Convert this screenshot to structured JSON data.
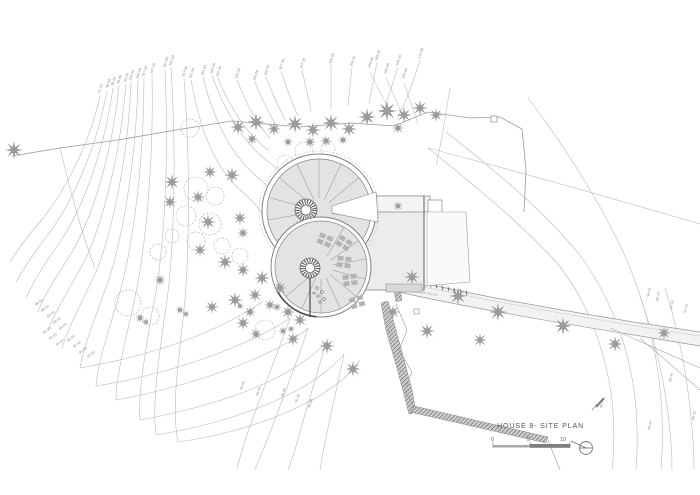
{
  "title_block": {
    "title": "HOUSE 8- SITE PLAN",
    "scale_marks": [
      "0",
      "5",
      "10"
    ]
  },
  "road_label": "ACCESS ROAD",
  "colors": {
    "paper": "#ffffff",
    "contour_line": "#b9b9b9",
    "building_fill": "#e3e3e3",
    "building_line": "#828282",
    "tree": "#9b9b9b",
    "wall_hatch": "#555555",
    "title_text": "#555555"
  },
  "contour_labels": [
    {
      "t": "97.50",
      "x": 100,
      "y": 93,
      "r": -72
    },
    {
      "t": "98.00",
      "x": 108,
      "y": 88,
      "r": -72
    },
    {
      "t": "98.50",
      "x": 113,
      "y": 86,
      "r": -72
    },
    {
      "t": "99.00",
      "x": 119,
      "y": 84,
      "r": -72
    },
    {
      "t": "99.50",
      "x": 126,
      "y": 82,
      "r": -72
    },
    {
      "t": "100.00",
      "x": 131,
      "y": 81,
      "r": -72
    },
    {
      "t": "100.50",
      "x": 138,
      "y": 79,
      "r": -72
    },
    {
      "t": "101.00",
      "x": 144,
      "y": 77,
      "r": -72
    },
    {
      "t": "101.50",
      "x": 152,
      "y": 74,
      "r": -72
    },
    {
      "t": "102.00",
      "x": 165,
      "y": 68,
      "r": -72
    },
    {
      "t": "102.50",
      "x": 171,
      "y": 66,
      "r": -72
    },
    {
      "t": "103.00",
      "x": 184,
      "y": 77,
      "r": -72
    },
    {
      "t": "103.50",
      "x": 191,
      "y": 79,
      "r": -72
    },
    {
      "t": "104.00",
      "x": 203,
      "y": 76,
      "r": -72
    },
    {
      "t": "104.50",
      "x": 212,
      "y": 74,
      "r": -72
    },
    {
      "t": "105.00",
      "x": 218,
      "y": 77,
      "r": -72
    },
    {
      "t": "105.50",
      "x": 237,
      "y": 79,
      "r": -72
    },
    {
      "t": "106.00",
      "x": 255,
      "y": 81,
      "r": -72
    },
    {
      "t": "106.50",
      "x": 266,
      "y": 76,
      "r": -72
    },
    {
      "t": "107.00",
      "x": 281,
      "y": 70,
      "r": -72
    },
    {
      "t": "107.50",
      "x": 302,
      "y": 69,
      "r": -72
    },
    {
      "t": "108.00",
      "x": 331,
      "y": 64,
      "r": -72
    },
    {
      "t": "108.50",
      "x": 352,
      "y": 67,
      "r": -72
    },
    {
      "t": "109.00",
      "x": 377,
      "y": 61,
      "r": -72
    },
    {
      "t": "109.50",
      "x": 398,
      "y": 66,
      "r": -72
    },
    {
      "t": "110.00",
      "x": 420,
      "y": 59,
      "r": -72
    },
    {
      "t": "100.00",
      "x": 370,
      "y": 68,
      "r": -72
    },
    {
      "t": "100.00",
      "x": 386,
      "y": 74,
      "r": -72
    },
    {
      "t": "100.00",
      "x": 404,
      "y": 79,
      "r": -72
    },
    {
      "t": "88.00",
      "x": 36,
      "y": 306,
      "r": -38
    },
    {
      "t": "88.50",
      "x": 42,
      "y": 312,
      "r": -38
    },
    {
      "t": "89.00",
      "x": 48,
      "y": 318,
      "r": -38
    },
    {
      "t": "89.50",
      "x": 54,
      "y": 324,
      "r": -38
    },
    {
      "t": "90.00",
      "x": 60,
      "y": 330,
      "r": -38
    },
    {
      "t": "90.50",
      "x": 44,
      "y": 334,
      "r": -38
    },
    {
      "t": "91.00",
      "x": 50,
      "y": 340,
      "r": -38
    },
    {
      "t": "91.50",
      "x": 57,
      "y": 346,
      "r": -38
    },
    {
      "t": "92.00",
      "x": 68,
      "y": 342,
      "r": -38
    },
    {
      "t": "92.50",
      "x": 74,
      "y": 348,
      "r": -38
    },
    {
      "t": "93.00",
      "x": 80,
      "y": 354,
      "r": -38
    },
    {
      "t": "93.50",
      "x": 88,
      "y": 358,
      "r": -38
    },
    {
      "t": "94.00",
      "x": 242,
      "y": 390,
      "r": -72
    },
    {
      "t": "94.50",
      "x": 258,
      "y": 396,
      "r": -72
    },
    {
      "t": "95.00",
      "x": 283,
      "y": 397,
      "r": -72
    },
    {
      "t": "95.50",
      "x": 297,
      "y": 403,
      "r": -72
    },
    {
      "t": "96.00",
      "x": 310,
      "y": 408,
      "r": -72
    },
    {
      "t": "96.00",
      "x": 649,
      "y": 297,
      "r": -78
    },
    {
      "t": "96.50",
      "x": 658,
      "y": 301,
      "r": -78
    },
    {
      "t": "97.00",
      "x": 672,
      "y": 309,
      "r": -78
    },
    {
      "t": "97.50",
      "x": 686,
      "y": 313,
      "r": -78
    },
    {
      "t": "98.00",
      "x": 602,
      "y": 408,
      "r": -78
    },
    {
      "t": "98.50",
      "x": 671,
      "y": 382,
      "r": -78
    },
    {
      "t": "99.00",
      "x": 650,
      "y": 430,
      "r": -78
    },
    {
      "t": "99.50",
      "x": 694,
      "y": 420,
      "r": -78
    }
  ]
}
